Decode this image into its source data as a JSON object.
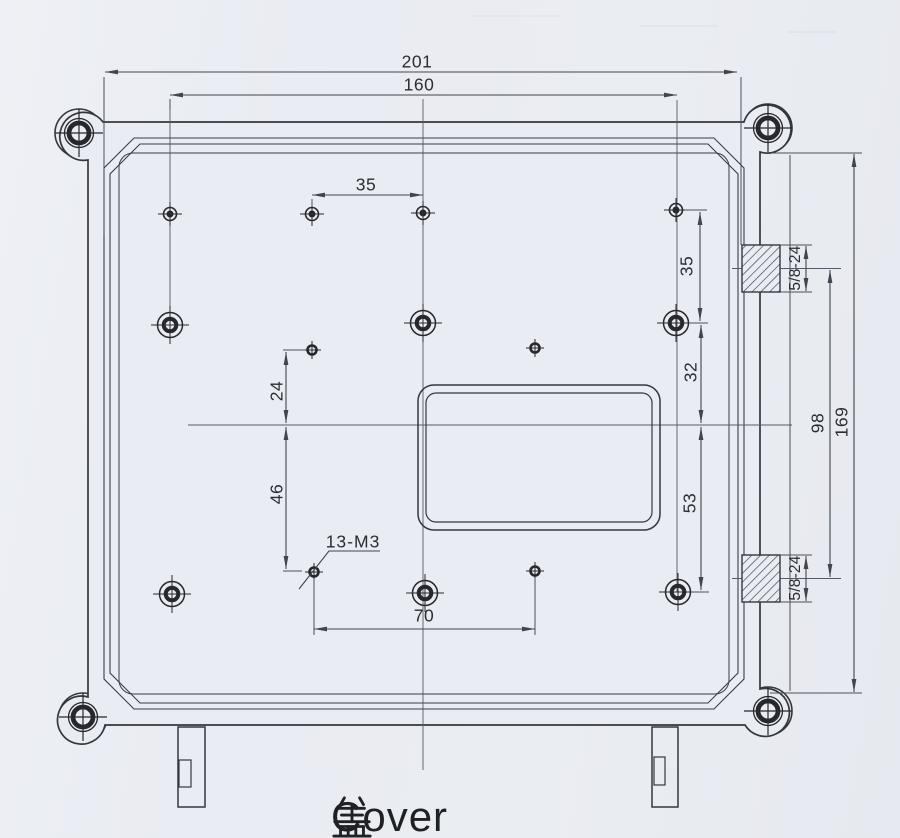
{
  "drawing": {
    "title_cn": "盖",
    "title_en": "Cover",
    "dims": {
      "overall_width": "201",
      "hole_span_width": "160",
      "top_hole_spacing": "35",
      "right_upper_spacing": "35",
      "right_mid_spacing": "32",
      "right_lower_spacing": "53",
      "left_upper_spacing": "24",
      "left_lower_spacing": "46",
      "bottom_hole_spacing": "70",
      "connector_span": "98",
      "overall_height": "169",
      "thread_spec_top": "5/8-24",
      "thread_spec_bottom": "5/8-24",
      "tapped_holes_callout": "13-M3"
    },
    "colors": {
      "line": "#34373e",
      "dim_line": "#434959",
      "text": "#2b2d33",
      "paper": "#e9ecf2"
    }
  }
}
